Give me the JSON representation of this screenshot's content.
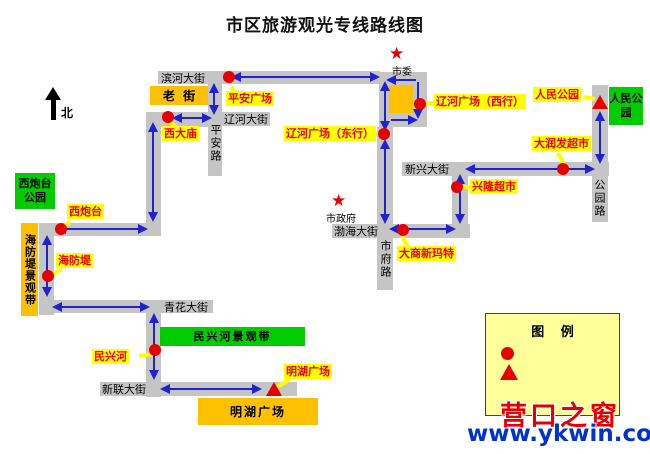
{
  "title": "市区旅游观光专线路线图",
  "compass": {
    "label": "北"
  },
  "icons": {
    "star": "★"
  },
  "streets": {
    "binhe": "滨河大街",
    "liaohe": "辽河大街",
    "pingan_road": "平安路",
    "qinghua": "青花大街",
    "xinlian": "新联大街",
    "xinxing": "新兴大街",
    "bohai": "渤海大街",
    "shifu_road": "市府路",
    "gongyuan_road": "公园路"
  },
  "stations": {
    "pingan_square": "平安广场",
    "xidamiao": "西大庙",
    "liaohe_square_west": "辽河广场（西行）",
    "liaohe_square_east": "辽河广场（东行）",
    "renmin_park": "人民公园",
    "darunfa": "大润发超市",
    "xinglong": "兴隆超市",
    "dashang_newmart": "大商新玛特",
    "xipaotai": "西炮台",
    "haifangdi": "海防堤",
    "minxinghe": "民兴河",
    "minghu_square": "明湖广场"
  },
  "areas": {
    "laojie": "老 街",
    "xipaotai_park": "西炮台公园",
    "renmin_park_area": "人民公园",
    "haifangdi_belt": "海防堤景观带",
    "minxinghe_belt": "民兴河景观带",
    "minghu_plaza": "明湖广场"
  },
  "landmarks": {
    "shiwei": "市委",
    "shizhengfu": "市政府"
  },
  "legend": {
    "title": "图 例",
    "station_label": "线路站点位置",
    "terminus_label": "起始站位置",
    "direction_label": "线路走向"
  },
  "watermark": {
    "brand": "营口之窗",
    "site": "www.ykwin.com"
  },
  "colors": {
    "route": "#2121CE",
    "street": "#C5C5C5",
    "station_label_bg": "#FFFF00",
    "station_text": "#EE0000",
    "area_green": "#00CC00",
    "area_orange": "#FFC000",
    "marker_red": "#E60000",
    "legend_bg": "#FFFF99",
    "watermark_blue": "#0033CC"
  }
}
